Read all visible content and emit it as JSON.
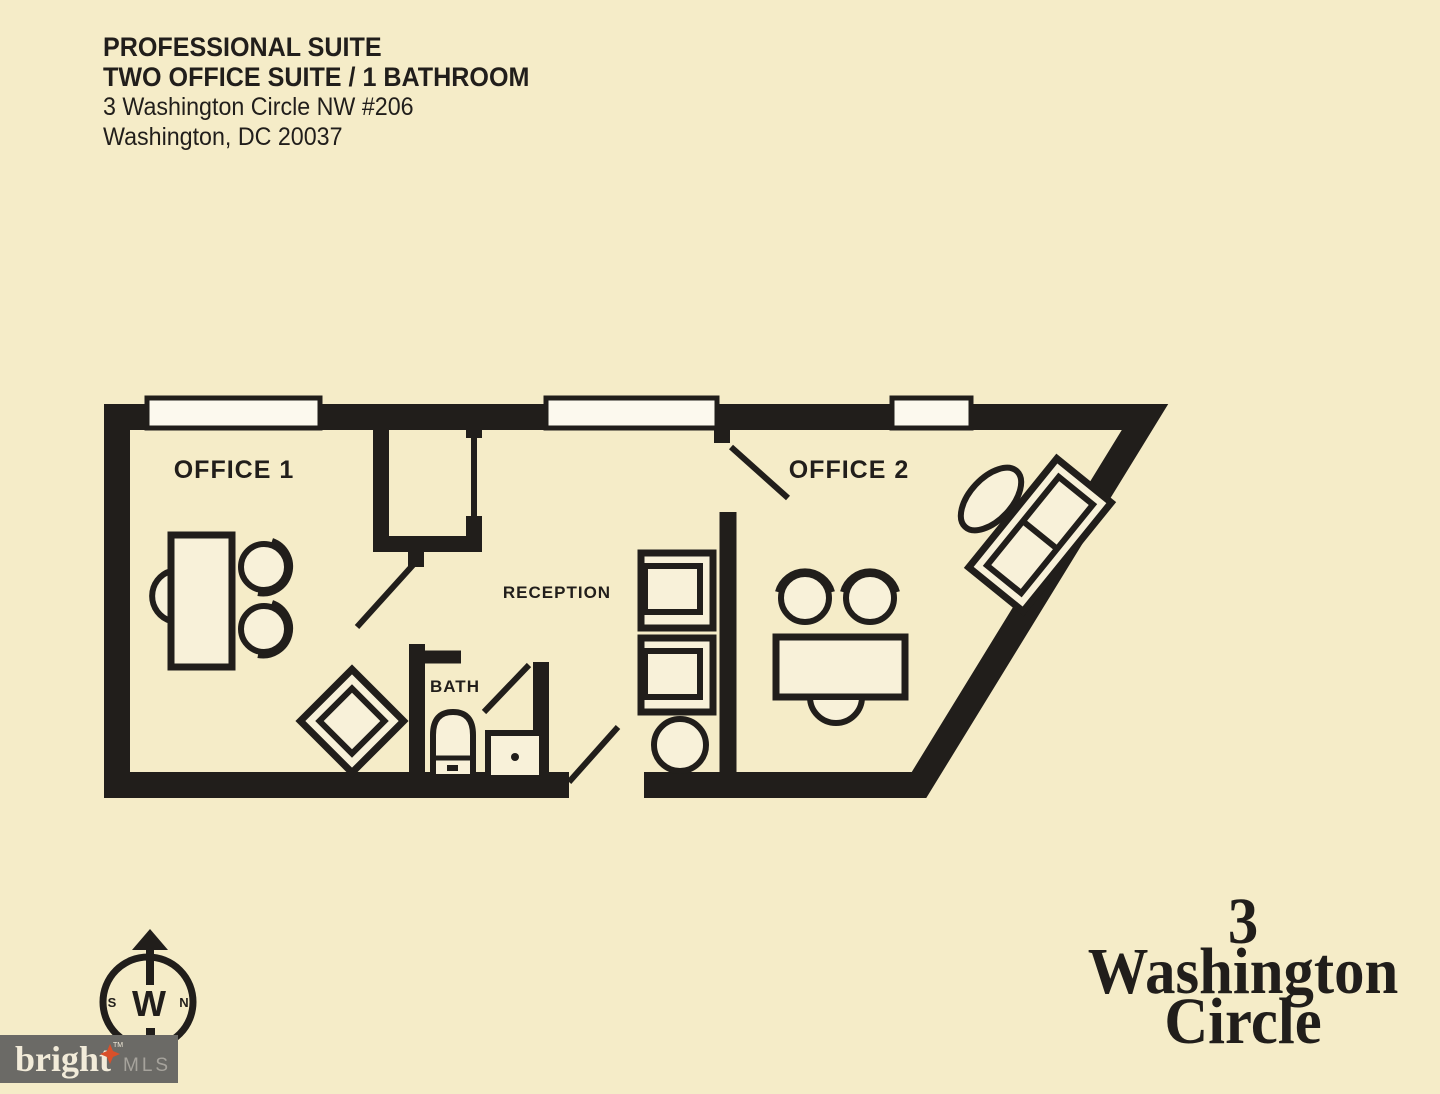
{
  "document": {
    "title_line1": "PROFESSIONAL SUITE",
    "title_line2": "TWO OFFICE SUITE / 1 BATHROOM",
    "address_line1": "3 Washington Circle NW #206",
    "address_line2": "Washington, DC 20037"
  },
  "plan": {
    "office1_label": "OFFICE 1",
    "office2_label": "OFFICE 2",
    "reception_label": "RECEPTION",
    "bath_label": "BATH"
  },
  "compass": {
    "west": "W",
    "south": "S",
    "north": "N"
  },
  "branding": {
    "building_lines": [
      "3",
      "Washington",
      "Circle"
    ],
    "logo_name": "bright",
    "logo_tm": "TM",
    "logo_mls": "MLS"
  },
  "colors": {
    "bg": "#f5ecc8",
    "ink": "#211e1b",
    "furniture_fill": "#f8f1d9",
    "window_fill": "#fcf9ee",
    "logo_bg": "#6b6a66",
    "logo_text": "#f2ebd9",
    "logo_star": "#d9502a",
    "logo_mls": "#a6a39c"
  }
}
